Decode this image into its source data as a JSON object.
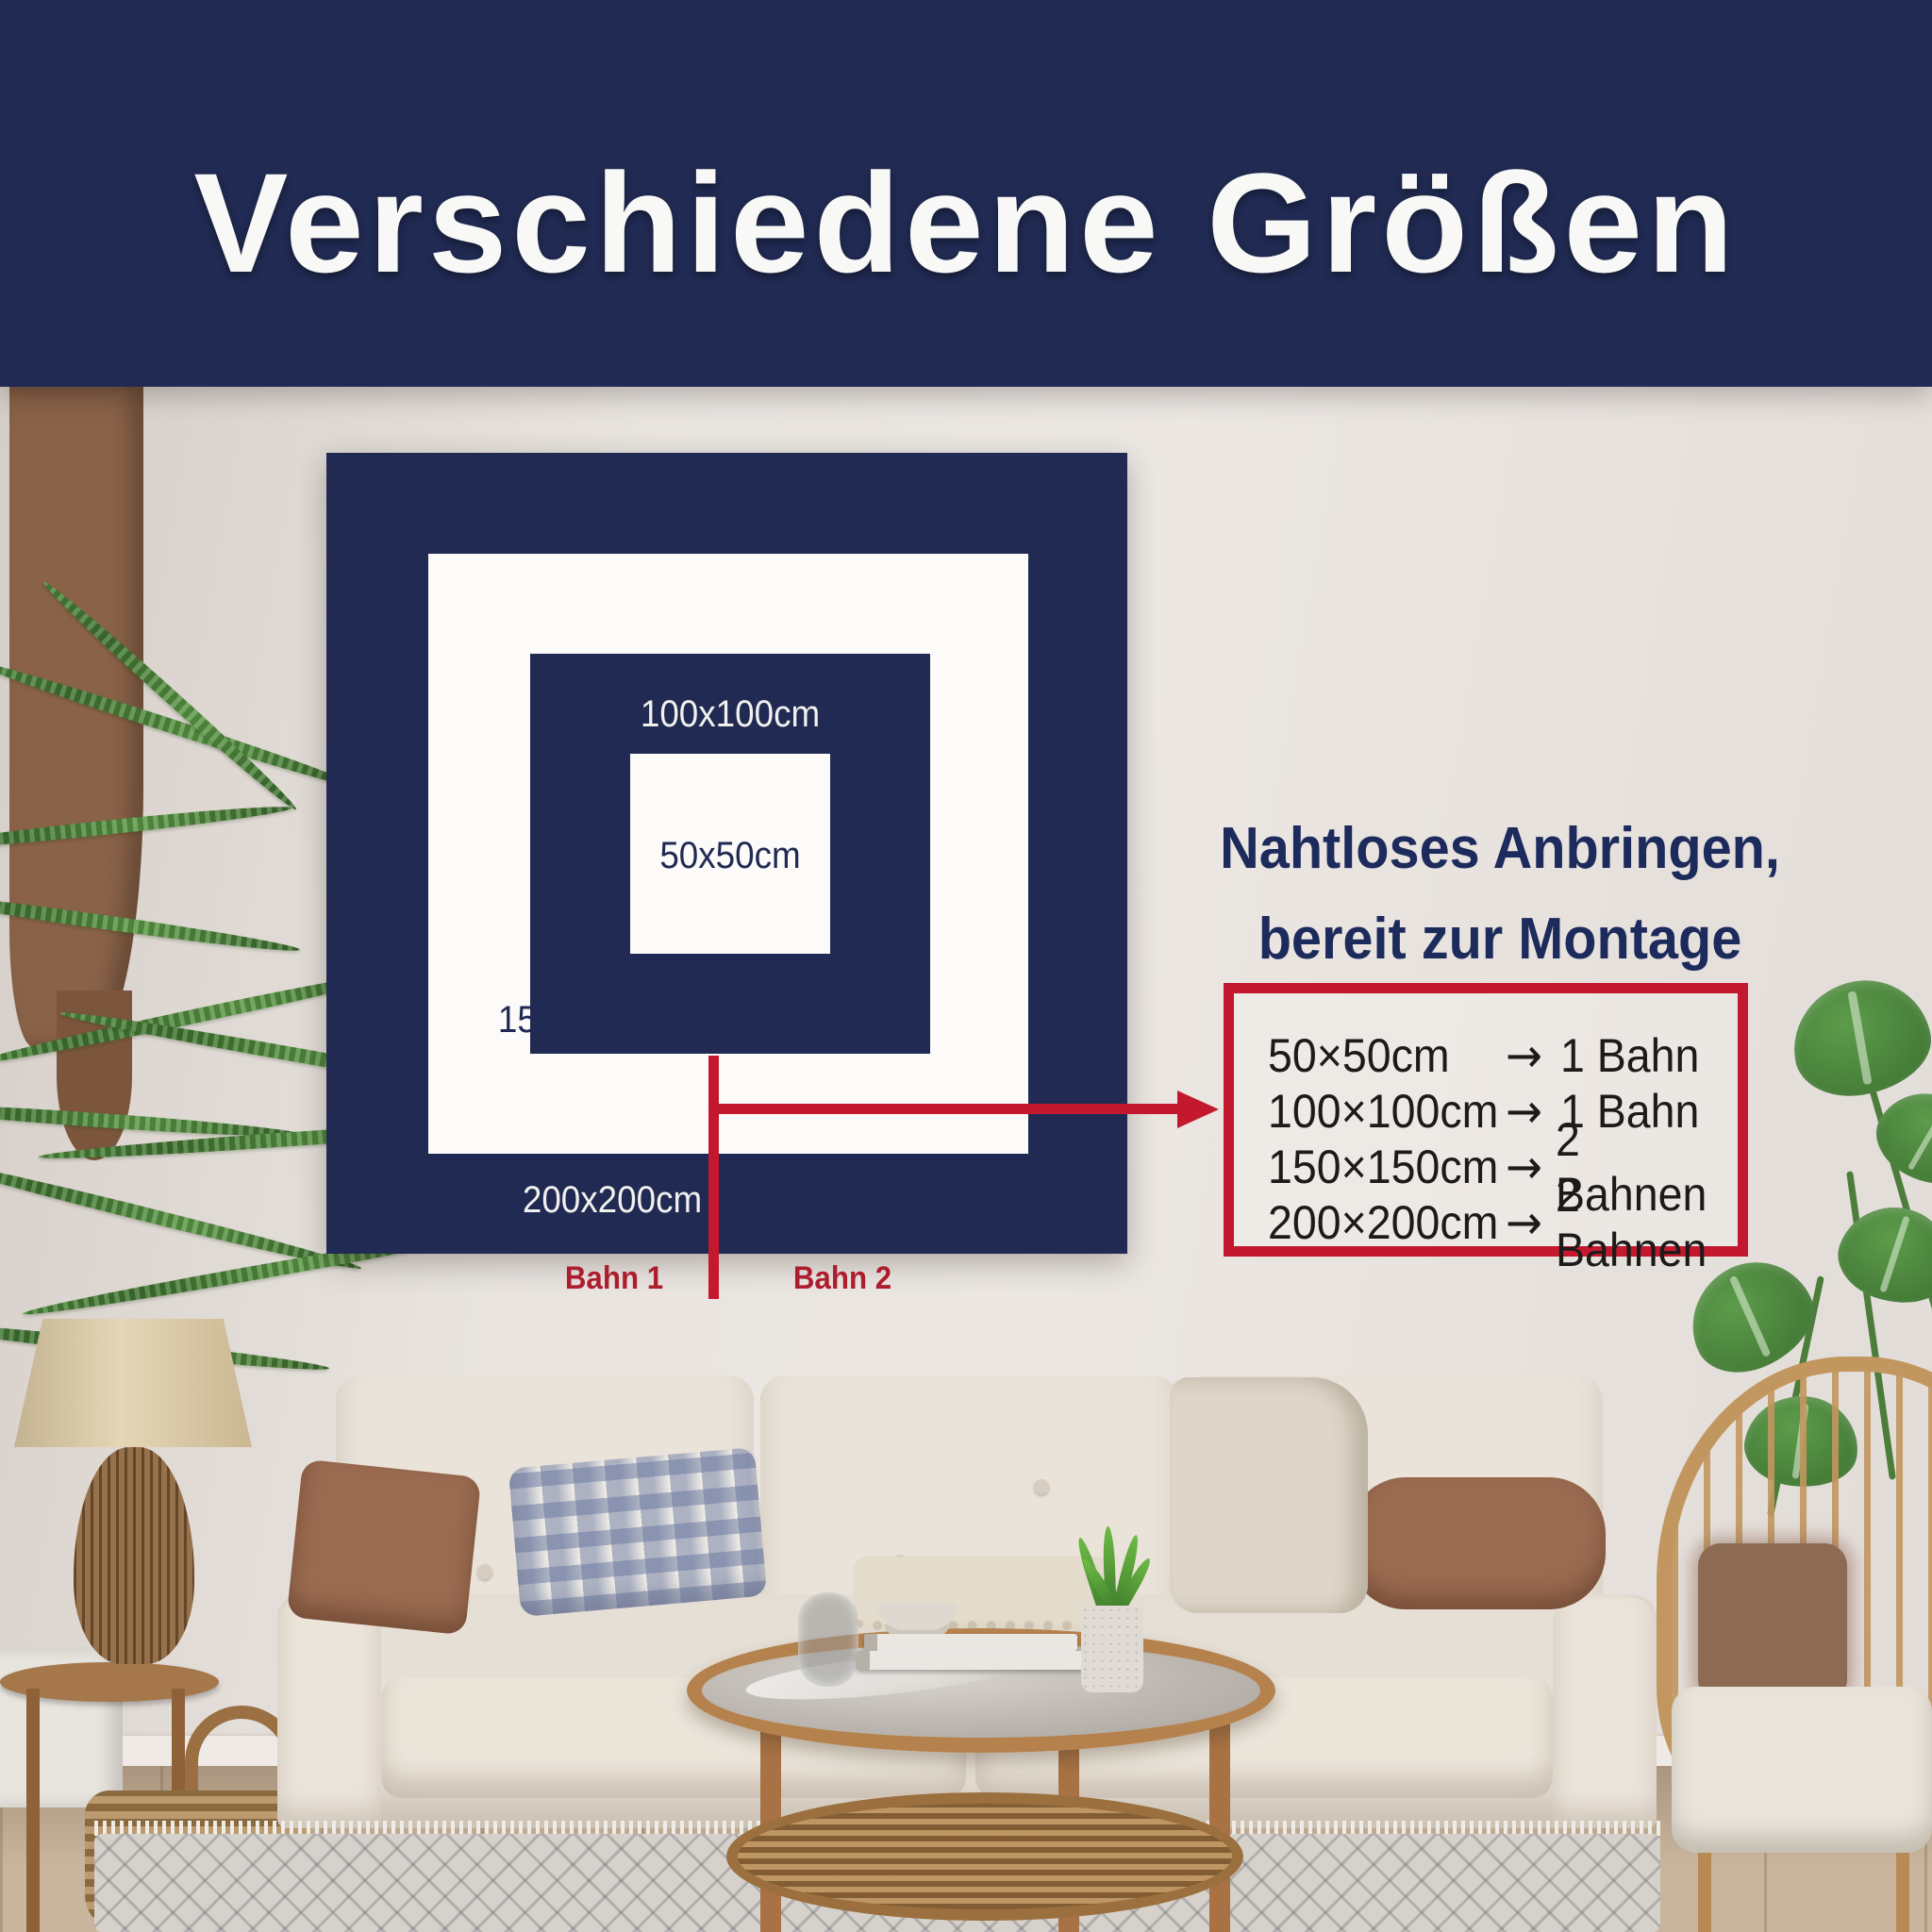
{
  "header": {
    "title": "Verschiedene Größen"
  },
  "size_diagram": {
    "label_100": "100x100cm",
    "label_50": "50x50cm",
    "label_150": "150x150cm",
    "label_200": "200x200cm",
    "bahn_1": "Bahn 1",
    "bahn_2": "Bahn 2"
  },
  "mounting_info": {
    "heading_line_1": "Nahtloses Anbringen,",
    "heading_line_2": "bereit zur Montage",
    "rows": [
      {
        "size": "50×50cm",
        "arrow": "→",
        "panels": "1 Bahn"
      },
      {
        "size": "100×100cm",
        "arrow": "→",
        "panels": "1 Bahn"
      },
      {
        "size": "150×150cm",
        "arrow": "→",
        "panels": "2 Bahnen"
      },
      {
        "size": "200×200cm",
        "arrow": "→",
        "panels": "2 Bahnen"
      }
    ]
  },
  "colors": {
    "navy": "#202a52",
    "red": "#c4182f",
    "wall": "#e7e2de",
    "list_text": "#1c1b1a",
    "heading_text": "#1d2b5c",
    "bahn_text": "#ae1d2e"
  }
}
